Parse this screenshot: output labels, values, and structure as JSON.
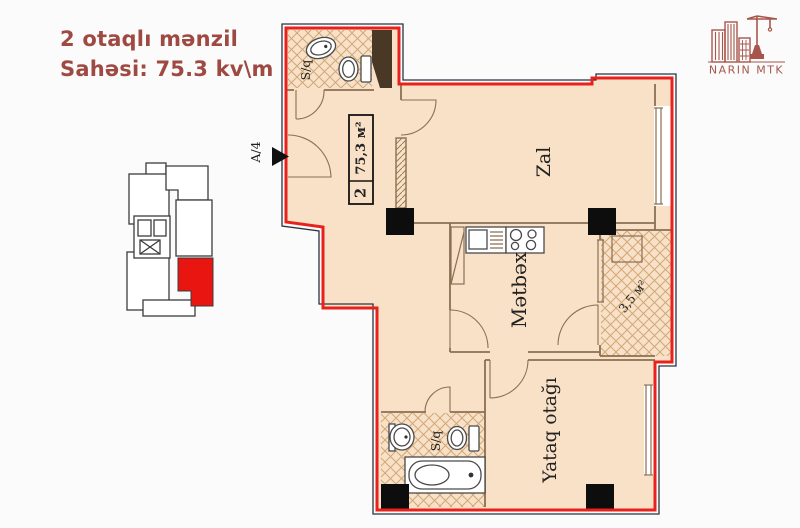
{
  "header": {
    "title_line1": "2 otaqlı mənzil",
    "title_line2": "Sahəsi: 75.3 kv\\m"
  },
  "logo": {
    "company": "NARIN MTK"
  },
  "floor_plan": {
    "section_label": "A/4",
    "apartment_tag": {
      "number": "2",
      "area": "75,3 м²"
    },
    "rooms": {
      "living": "Zal",
      "kitchen": "Mətbəx",
      "bedroom": "Yataq otağı",
      "bathroom_top": "S/q",
      "bathroom_bottom": "S/q",
      "balcony": "3,5 м²"
    },
    "colors": {
      "boundary_red": "#e8211c",
      "room_fill": "#f8e1c6",
      "wall_brown": "#8a6f52",
      "column_black": "#0d0d0d",
      "highlight_red": "#e81511",
      "title_red": "#9e4a42",
      "logo_red": "#a8564c"
    }
  }
}
